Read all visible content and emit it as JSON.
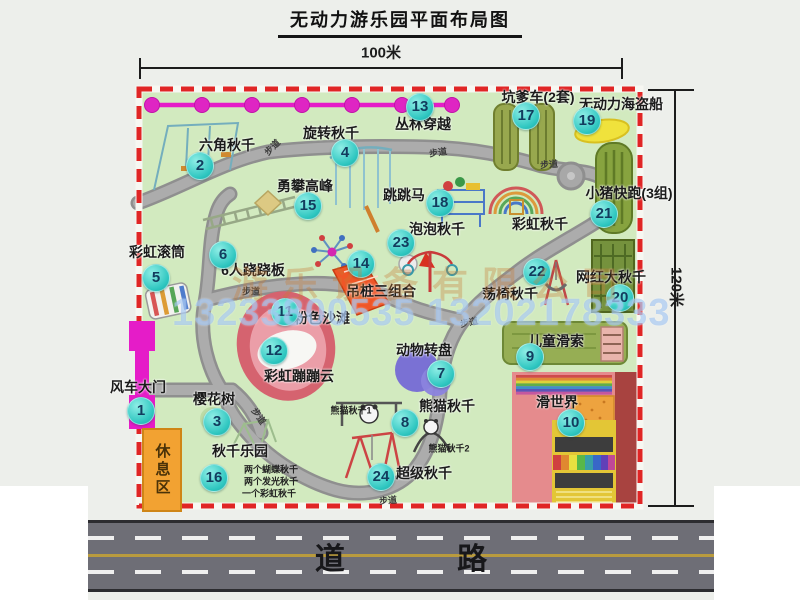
{
  "header": {
    "title": "无动力游乐园平面布局图"
  },
  "dimensions": {
    "width_label": "100米",
    "height_label": "120米"
  },
  "road": {
    "label": "道 路"
  },
  "watermark": {
    "company": "游乐设备有限公司",
    "phone": "13233800535 13202178333"
  },
  "colors": {
    "map_green": "#d2eabf",
    "path_gray": "#a8a8a8",
    "border_red": "#e02525",
    "badge_teal": "#2ec6c0",
    "gate_magenta": "#e51cc8",
    "road_gray": "#6e6e76",
    "rest_area_orange": "#f2a232",
    "watermark_blue": "rgba(150,190,240,0.6)"
  },
  "map": {
    "rest_area_label": "休息区",
    "items": [
      {
        "num": 1,
        "label": "风车大门",
        "pos": [
          138,
          387
        ],
        "badge": [
          140,
          410
        ]
      },
      {
        "num": 2,
        "label": "六角秋千",
        "pos": [
          227,
          145
        ],
        "badge": [
          199,
          165
        ]
      },
      {
        "num": 3,
        "label": "樱花树",
        "pos": [
          214,
          399
        ],
        "badge": [
          216,
          421
        ]
      },
      {
        "num": 4,
        "label": "旋转秋千",
        "pos": [
          331,
          133
        ],
        "badge": [
          344,
          152
        ]
      },
      {
        "num": 5,
        "label": "彩虹滚筒",
        "pos": [
          157,
          252
        ],
        "badge": [
          155,
          277
        ]
      },
      {
        "num": 6,
        "label": "6人跷跷板",
        "pos": [
          253,
          270
        ],
        "badge": [
          222,
          254
        ]
      },
      {
        "num": 7,
        "label": "动物转盘",
        "pos": [
          424,
          350
        ],
        "badge": [
          440,
          373
        ]
      },
      {
        "num": 8,
        "label": "熊猫秋千",
        "pos": [
          447,
          406
        ],
        "badge": [
          404,
          422
        ]
      },
      {
        "num": 9,
        "label": "儿童滑索",
        "pos": [
          556,
          341
        ],
        "badge": [
          529,
          356
        ]
      },
      {
        "num": 10,
        "label": "滑世界",
        "pos": [
          557,
          402
        ],
        "badge": [
          570,
          422
        ]
      },
      {
        "num": 11,
        "label": "粉色沙滩",
        "pos": [
          322,
          318
        ],
        "badge": [
          284,
          311
        ]
      },
      {
        "num": 12,
        "label": "彩虹蹦蹦云",
        "pos": [
          299,
          376
        ],
        "badge": [
          273,
          350
        ]
      },
      {
        "num": 13,
        "label": "丛林穿越",
        "pos": [
          423,
          124
        ],
        "badge": [
          419,
          106
        ]
      },
      {
        "num": 14,
        "label": "吊桩三组合",
        "pos": [
          381,
          291
        ],
        "badge": [
          360,
          263
        ]
      },
      {
        "num": 15,
        "label": "勇攀高峰",
        "pos": [
          305,
          186
        ],
        "badge": [
          307,
          205
        ]
      },
      {
        "num": 16,
        "label": "秋千乐园",
        "pos": [
          240,
          451
        ],
        "badge": [
          213,
          477
        ]
      },
      {
        "num": 17,
        "label": "坑爹车(2套)",
        "pos": [
          538,
          97
        ],
        "badge": [
          525,
          115
        ]
      },
      {
        "num": 18,
        "label": "跳跳马",
        "pos": [
          404,
          195
        ],
        "badge": [
          439,
          202
        ]
      },
      {
        "num": 19,
        "label": "无动力海盗船",
        "pos": [
          621,
          104
        ],
        "badge": [
          586,
          120
        ]
      },
      {
        "num": 20,
        "label": "网红大秋千",
        "pos": [
          611,
          277
        ],
        "badge": [
          619,
          297
        ]
      },
      {
        "num": 21,
        "label": "小猪快跑(3组)",
        "pos": [
          629,
          193
        ],
        "badge": [
          603,
          213
        ]
      },
      {
        "num": 22,
        "label": "荡椅秋千",
        "pos": [
          510,
          294
        ],
        "badge": [
          536,
          271
        ]
      },
      {
        "num": 23,
        "label": "泡泡秋千",
        "pos": [
          437,
          229
        ],
        "badge": [
          400,
          242
        ]
      },
      {
        "num": 24,
        "label": "超级秋千",
        "pos": [
          424,
          473
        ],
        "badge": [
          380,
          476
        ]
      },
      {
        "num": null,
        "label": "彩虹秋千",
        "pos": [
          540,
          224
        ],
        "badge": null
      }
    ],
    "small_labels": [
      {
        "text": "熊猫秋千1",
        "pos": [
          351,
          410
        ]
      },
      {
        "text": "熊猫秋千2",
        "pos": [
          449,
          448
        ]
      },
      {
        "text": "两个蝴蝶秋千",
        "pos": [
          271,
          469
        ]
      },
      {
        "text": "两个发光秋千",
        "pos": [
          271,
          481
        ]
      },
      {
        "text": "一个彩虹秋千",
        "pos": [
          269,
          493
        ]
      }
    ],
    "path_labels": [
      {
        "text": "步道",
        "pos": [
          272,
          147
        ],
        "rot": -45
      },
      {
        "text": "步道",
        "pos": [
          438,
          152
        ],
        "rot": -8
      },
      {
        "text": "步道",
        "pos": [
          549,
          164
        ],
        "rot": -5
      },
      {
        "text": "步道",
        "pos": [
          251,
          291
        ],
        "rot": 0
      },
      {
        "text": "步道",
        "pos": [
          469,
          322
        ],
        "rot": -12
      },
      {
        "text": "步道",
        "pos": [
          259,
          416
        ],
        "rot": 55
      },
      {
        "text": "步道",
        "pos": [
          388,
          500
        ],
        "rot": -5
      }
    ]
  }
}
